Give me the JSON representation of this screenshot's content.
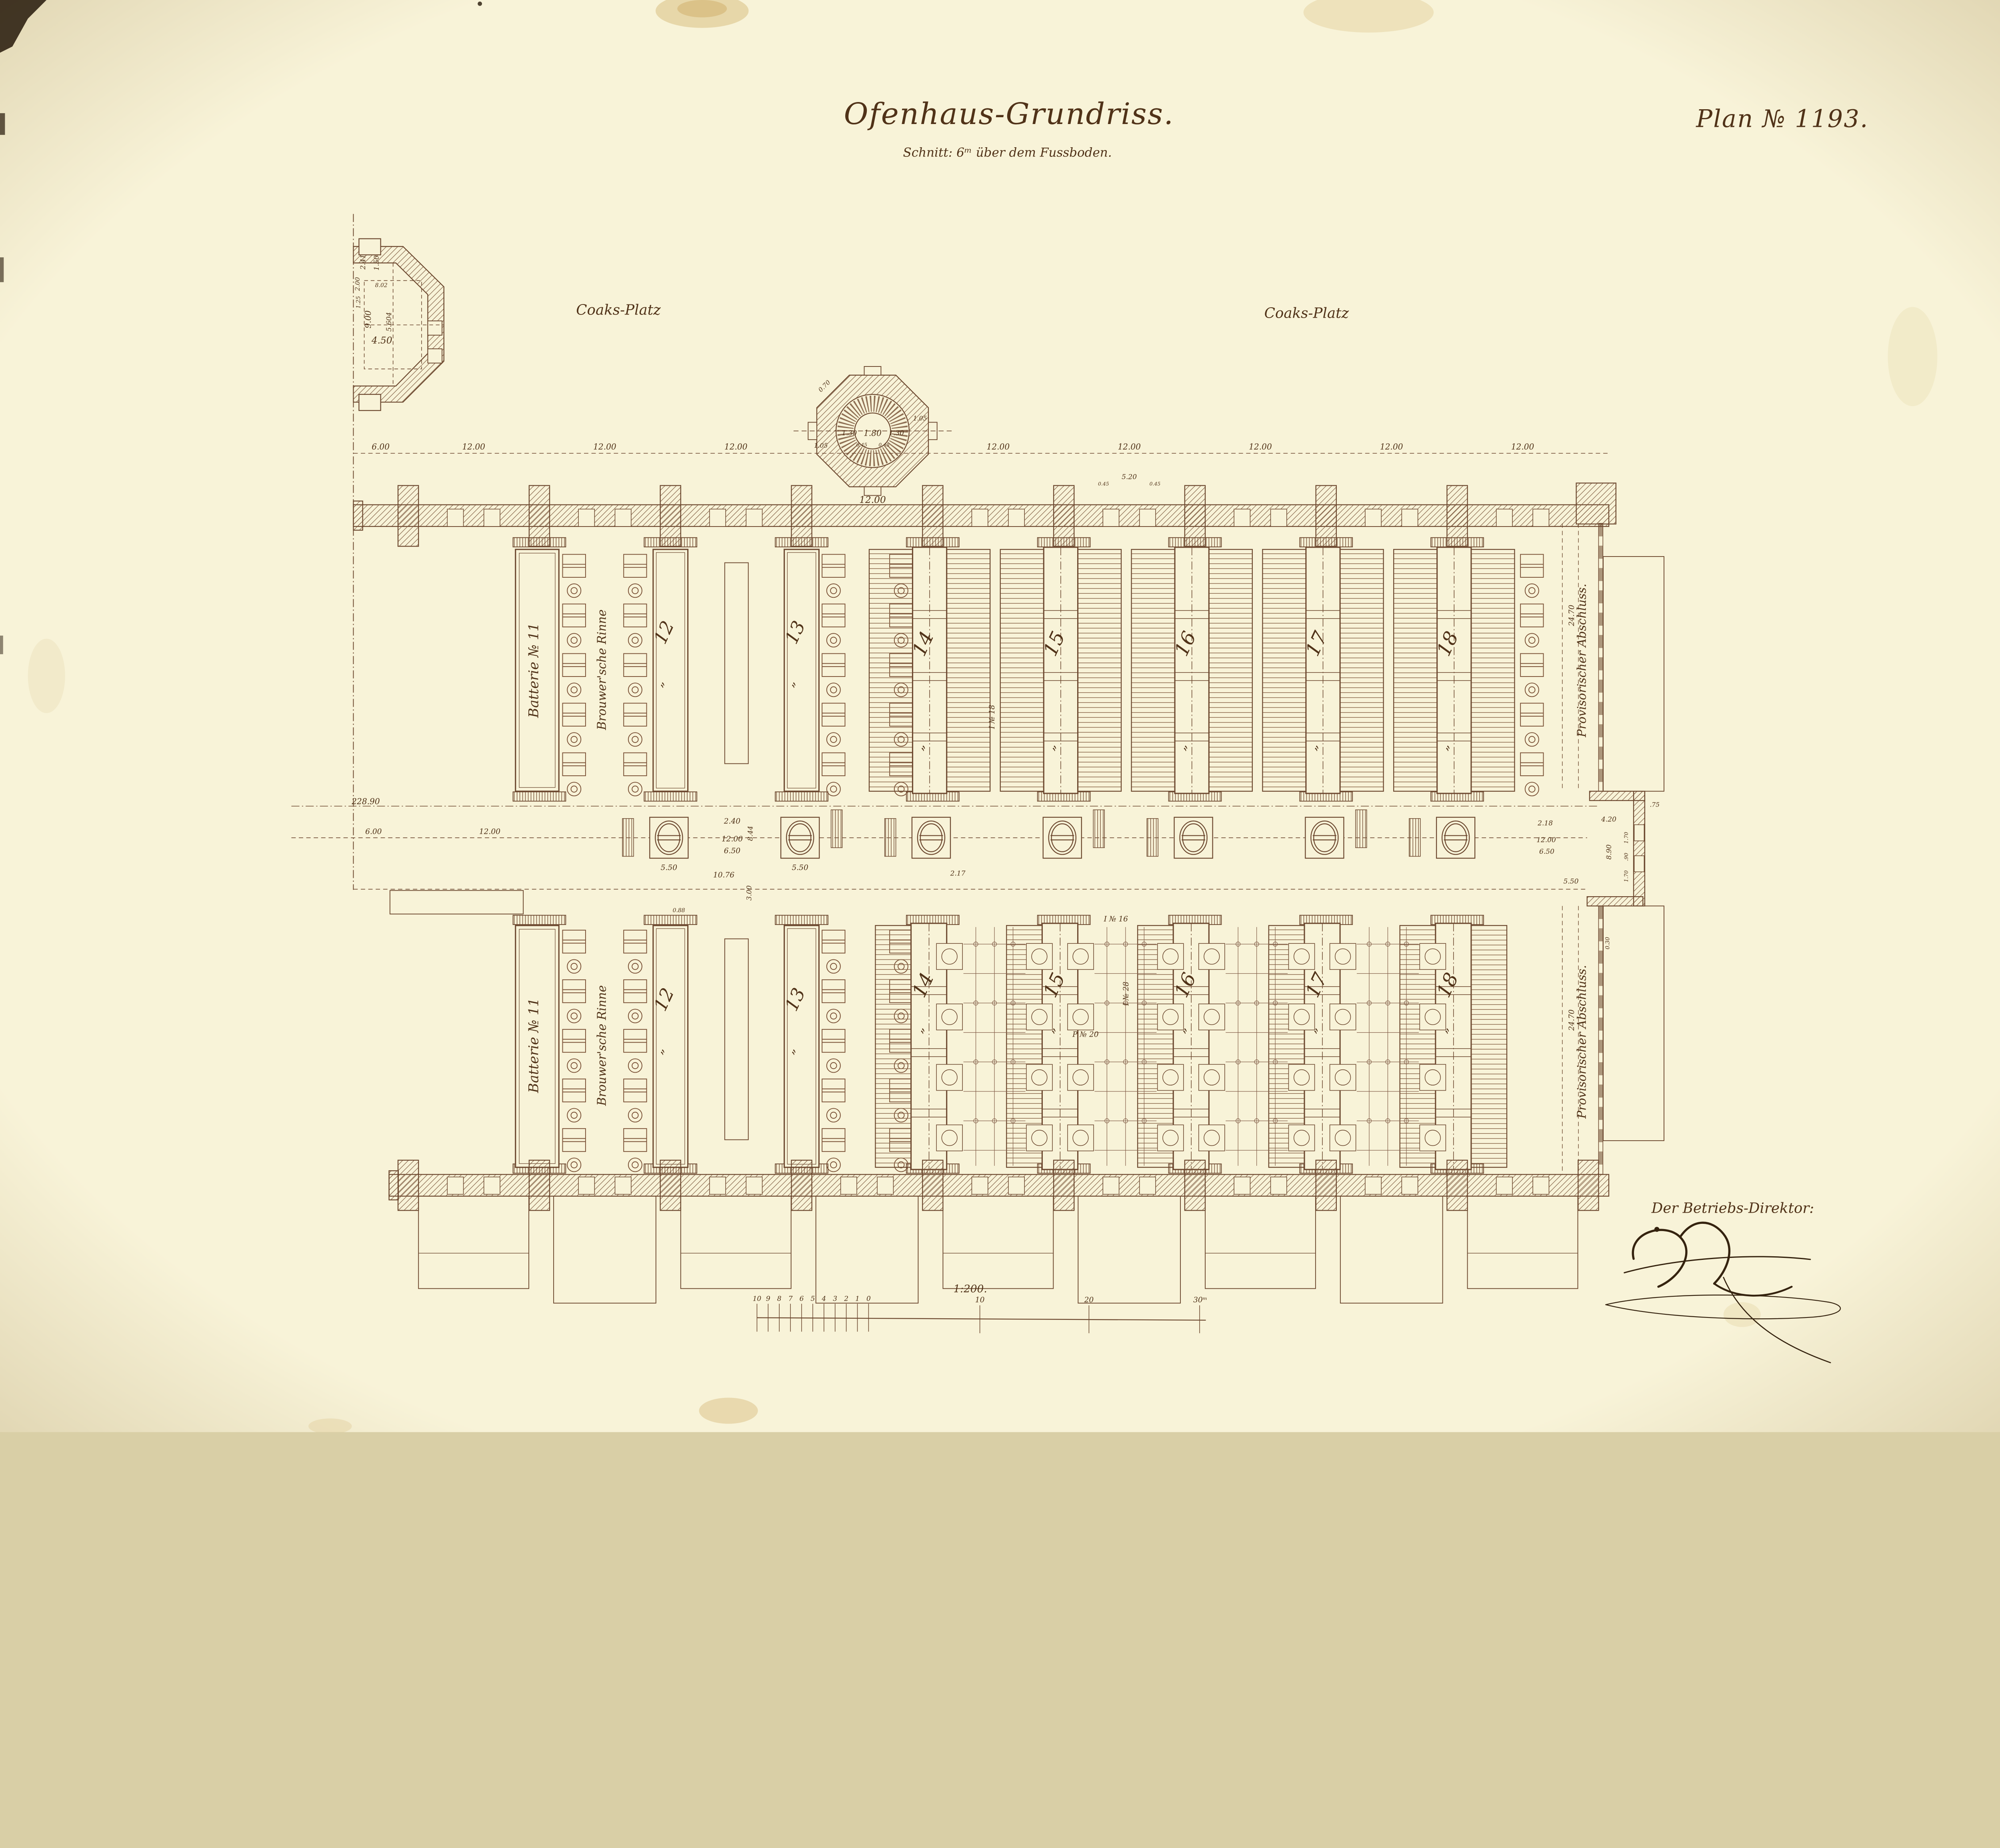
{
  "document": {
    "title": "Ofenhaus-Grundriss.",
    "subtitle": "Schnitt: 6ᵐ über dem Fussboden.",
    "plan_number": "Plan № 1193.",
    "scale_note": "1:200.",
    "director_label": "Der Betriebs-Direktor:"
  },
  "areas": {
    "coaks_platz_left": "Coaks-Platz",
    "coaks_platz_right": "Coaks-Platz"
  },
  "labels": {
    "battery_11": "Batterie № 11",
    "rinne": "Brouwer'sche Rinne",
    "abschluss": "Provisorischer Abschluss.",
    "beam_i16": "I № 16",
    "beam_i28": "I № 28",
    "beam_p20": "P № 20",
    "beam_i18": "I № 18",
    "ditto": "”"
  },
  "battery_numbers": {
    "upper": [
      "12",
      "13",
      "14",
      "15",
      "16",
      "17",
      "18"
    ],
    "lower": [
      "12",
      "13",
      "14",
      "15",
      "16",
      "17",
      "18"
    ]
  },
  "dims": {
    "d600": "6.00",
    "d1200": "12.00",
    "d22890": "228.90",
    "d650": "6.50",
    "d550": "5.50",
    "d240": "2.40",
    "d1076": "10.76",
    "d217": "2.17",
    "d218": "2.18",
    "d844": "8.44",
    "d300": "3.00",
    "d088": "0.88",
    "d2470": "24.70",
    "d420": "4.20",
    "d890": "8.90",
    "d170": "1.70",
    "d090": ".90",
    "d075": ".75",
    "d030": "0.30",
    "d180": "1.80",
    "d130": "1.30",
    "d105": "1.05",
    "d070": "0.70",
    "d045": "0.45",
    "d900": "9.00",
    "d450": "4.50",
    "d241": "2.41",
    "d150": "1.50",
    "d5604": "5.604",
    "d200": "2.00",
    "d125": "1.25",
    "d802": "8.02",
    "d520": "5.20"
  },
  "scale_bar": {
    "minor": [
      "10",
      "9",
      "8",
      "7",
      "6",
      "5",
      "4",
      "3",
      "2",
      "1",
      "0"
    ],
    "major": [
      "10",
      "20",
      "30ᵐ"
    ]
  },
  "colors": {
    "paper": "#f8f3d8",
    "ink": "#6d4930",
    "stain": "#d9c083"
  }
}
